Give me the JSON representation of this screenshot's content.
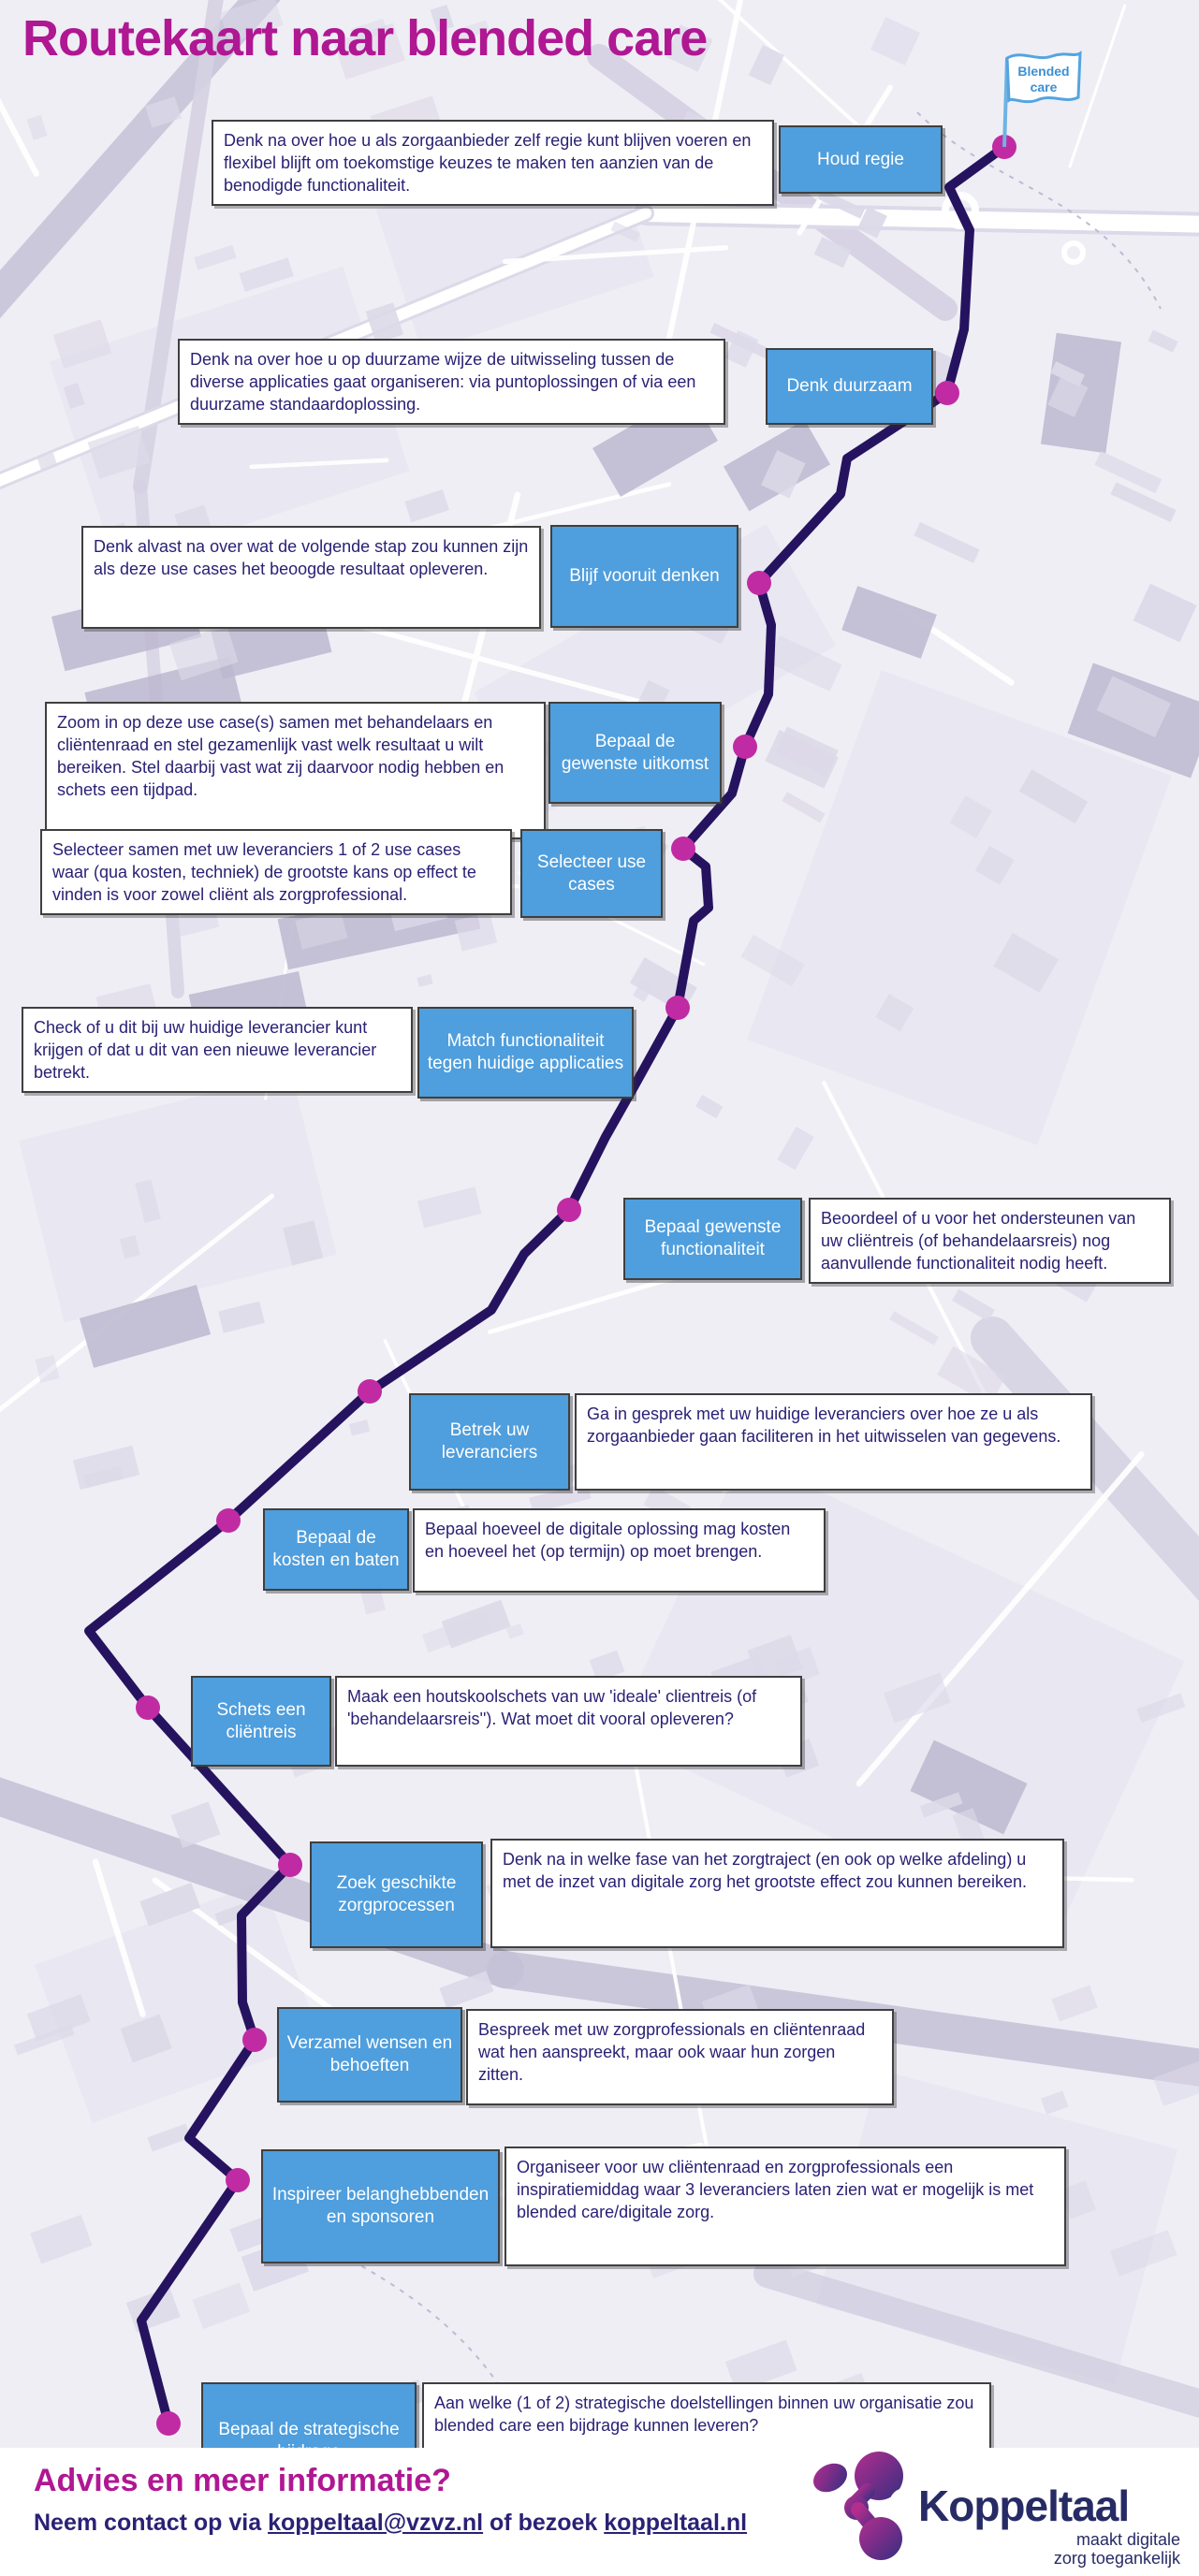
{
  "page": {
    "title": "Routekaart naar blended care"
  },
  "flag": {
    "line1": "Blended",
    "line2": "care"
  },
  "steps": [
    {
      "label": "Houd regie",
      "description": "Denk na over hoe u als zorgaanbieder zelf regie kunt blijven voeren en flexibel blijft om toekomstige keuzes te maken ten aanzien van de benodigde functionaliteit."
    },
    {
      "label": "Denk duurzaam",
      "description": "Denk na over hoe u op duurzame wijze de uitwisseling tussen de diverse applicaties gaat organiseren: via puntoplossingen of via een duurzame standaardoplossing."
    },
    {
      "label": "Blijf vooruit denken",
      "description": "Denk alvast na over wat de volgende stap zou kunnen zijn als deze use cases het beoogde resultaat opleveren."
    },
    {
      "label": "Bepaal de gewenste uitkomst",
      "description": "Zoom in op deze use case(s) samen met behandelaars en cliëntenraad en stel gezamenlijk vast welk resultaat u wilt bereiken. Stel daarbij vast wat zij daarvoor nodig hebben en schets een tijdpad."
    },
    {
      "label": "Selecteer use cases",
      "description": "Selecteer samen met uw leveranciers 1 of 2 use cases waar (qua kosten, techniek) de grootste kans op effect te vinden is voor zowel cliënt als zorgprofessional."
    },
    {
      "label": "Match functionaliteit tegen huidige applicaties",
      "description": "Check of u dit bij uw huidige leverancier kunt krijgen of dat u dit van een nieuwe leverancier betrekt."
    },
    {
      "label": "Bepaal gewenste functionaliteit",
      "description": "Beoordeel of u voor het ondersteunen van uw cliëntreis (of behandelaarsreis) nog aanvullende functionaliteit nodig heeft."
    },
    {
      "label": "Betrek uw leveranciers",
      "description": "Ga in gesprek met uw huidige leveranciers over hoe ze u als zorgaanbieder gaan faciliteren in het uitwisselen van gegevens."
    },
    {
      "label": "Bepaal de kosten en baten",
      "description": "Bepaal hoeveel de digitale oplossing mag kosten en hoeveel het (op termijn) op moet brengen."
    },
    {
      "label": "Schets een cliëntreis",
      "description": "Maak een houtskoolschets van uw 'ideale' clientreis (of 'behandelaarsreis''). Wat moet dit vooral opleveren?"
    },
    {
      "label": "Zoek geschikte zorgprocessen",
      "description": "Denk na in welke fase van het zorgtraject (en ook op welke afdeling) u met de inzet van digitale zorg het grootste effect zou kunnen bereiken."
    },
    {
      "label": "Verzamel wensen en behoeften",
      "description": "Bespreek met uw zorgprofessionals en cliëntenraad wat hen aanspreekt, maar ook waar hun zorgen zitten."
    },
    {
      "label": "Inspireer belanghebbenden en sponsoren",
      "description": "Organiseer voor uw cliëntenraad en zorgprofessionals een inspiratiemiddag waar 3 leveranciers laten zien wat er mogelijk is met blended care/digitale zorg."
    },
    {
      "label": "Bepaal de strategische bijdrage",
      "description": "Aan welke (1 of 2) strategische doelstellingen binnen uw organisatie zou blended care een bijdrage kunnen leveren?"
    }
  ],
  "footer": {
    "heading": "Advies en meer informatie?",
    "contact_prefix": "Neem contact op via ",
    "email": "koppeltaal@vzvz.nl",
    "contact_middle": " of bezoek ",
    "website": "koppeltaal.nl",
    "logo_name": "Koppeltaal",
    "logo_tagline_line1": "maakt digitale",
    "logo_tagline_line2": "zorg toegankelijk"
  },
  "colors": {
    "button_blue": "#4f9edd",
    "route_indigo": "#26135f",
    "milestone_magenta": "#c02ba3",
    "title_magenta": "#b01793",
    "text_navy": "#2a2175",
    "flag_blue": "#54a4e0",
    "logo_navy": "#272b65"
  }
}
